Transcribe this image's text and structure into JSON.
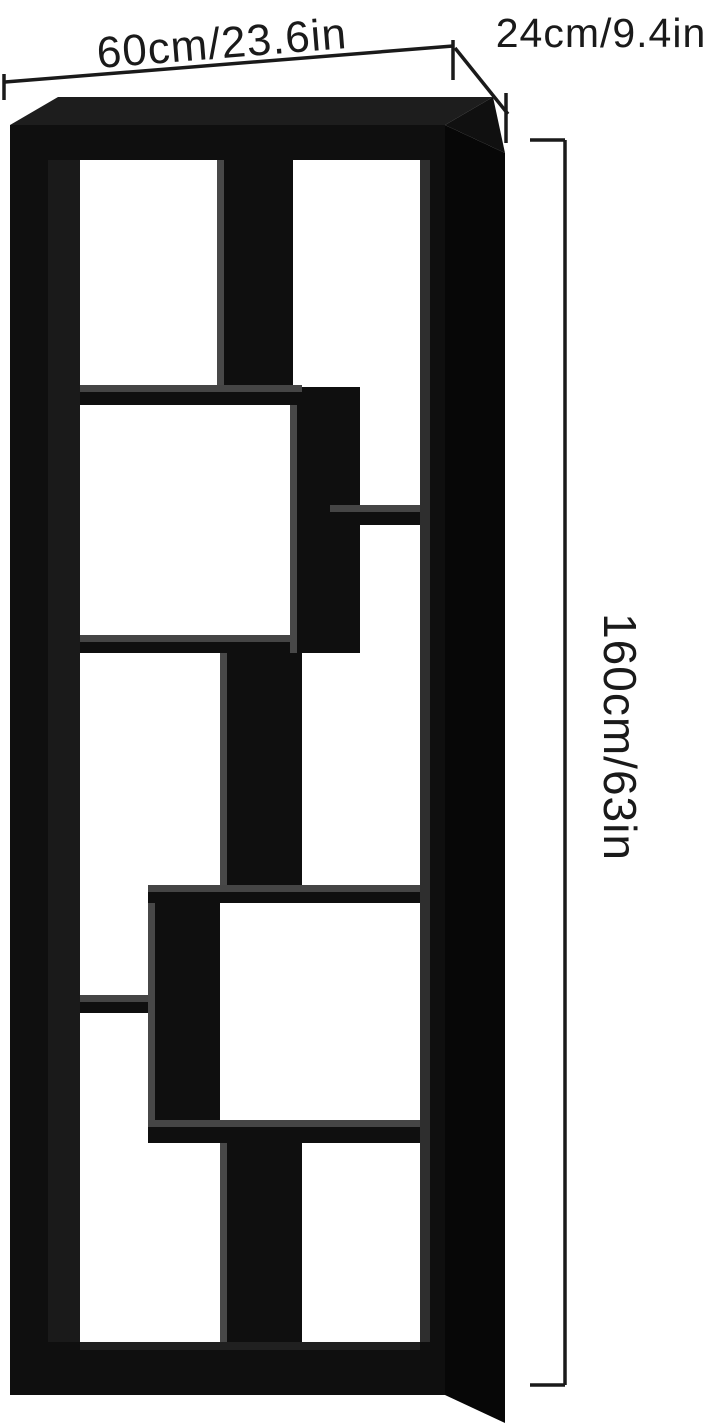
{
  "figure": {
    "subject": "Black staggered 8-cube bookshelf dimension diagram",
    "background_color": "#ffffff",
    "canvas": {
      "width": 723,
      "height": 1425
    }
  },
  "dimensions": {
    "width": {
      "label": "60cm/23.6in"
    },
    "depth": {
      "label": "24cm/9.4in"
    },
    "height": {
      "label": "160cm/63in"
    }
  },
  "colors": {
    "shelf_front": "#0f0f0f",
    "shelf_top_face": "#1d1d1d",
    "shelf_side_face": "#070707",
    "shelf_surface_gray": "#454545",
    "divider_edge_gray": "#484848",
    "inner_wall_gray": "#2e2e2e",
    "line_color": "#1a1a1a",
    "text_color": "#1a1a1a"
  }
}
